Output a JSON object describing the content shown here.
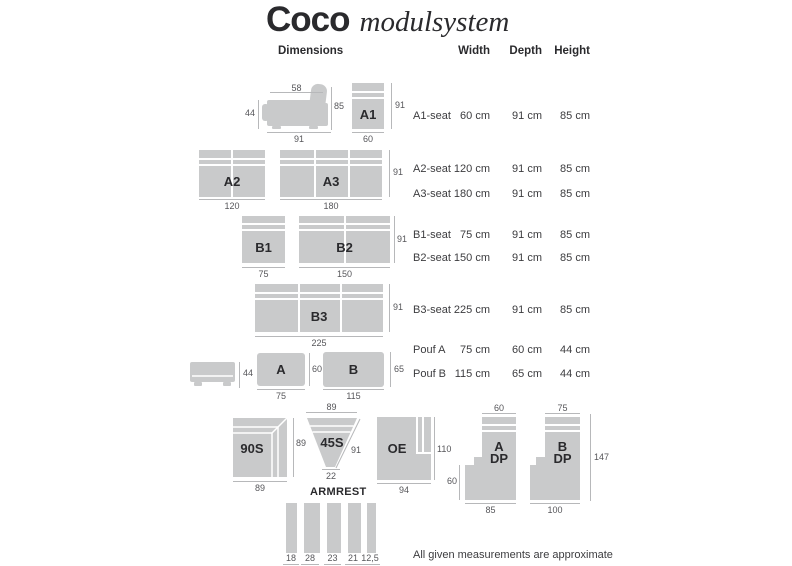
{
  "title": {
    "brand": "Coco",
    "suffix": "modulsystem"
  },
  "colors": {
    "module_fill": "#c9cacb",
    "line": "#b7b8ba",
    "dim_text": "#56565a",
    "text": "#3c3c3f",
    "heading_text": "#2a2a2d"
  },
  "sections": {
    "dimensions_label": "Dimensions",
    "armrest_label": "ARMREST"
  },
  "table": {
    "headers": {
      "width": "Width",
      "depth": "Depth",
      "height": "Height"
    },
    "rows": [
      {
        "name": "A1-seat",
        "width": "60 cm",
        "depth": "91 cm",
        "height": "85 cm"
      },
      {
        "name": "A2-seat",
        "width": "120 cm",
        "depth": "91 cm",
        "height": "85 cm"
      },
      {
        "name": "A3-seat",
        "width": "180 cm",
        "depth": "91 cm",
        "height": "85 cm"
      },
      {
        "name": "B1-seat",
        "width": "75 cm",
        "depth": "91 cm",
        "height": "85 cm"
      },
      {
        "name": "B2-seat",
        "width": "150 cm",
        "depth": "91 cm",
        "height": "85 cm"
      },
      {
        "name": "B3-seat",
        "width": "225 cm",
        "depth": "91 cm",
        "height": "85 cm"
      },
      {
        "name": "Pouf A",
        "width": "75 cm",
        "depth": "60 cm",
        "height": "44 cm"
      },
      {
        "name": "Pouf B",
        "width": "115 cm",
        "depth": "65 cm",
        "height": "44 cm"
      }
    ]
  },
  "modules": {
    "a1_side": {
      "top": "58",
      "left": "44",
      "right": "85",
      "bottom": "91"
    },
    "a1": {
      "label": "A1",
      "right": "91",
      "bottom": "60"
    },
    "a2": {
      "label": "A2",
      "bottom": "120"
    },
    "a3": {
      "label": "A3",
      "bottom": "180",
      "right": "91"
    },
    "b1": {
      "label": "B1",
      "bottom": "75"
    },
    "b2": {
      "label": "B2",
      "bottom": "150",
      "right": "91"
    },
    "b3": {
      "label": "B3",
      "bottom": "225",
      "right": "91"
    },
    "pouf_side": {
      "left": "44"
    },
    "pouf_a": {
      "label": "A",
      "right": "60",
      "bottom": "75"
    },
    "pouf_b": {
      "label": "B",
      "right": "65",
      "bottom": "115"
    },
    "corner_90": {
      "label": "90S",
      "right": "89",
      "bottom": "89"
    },
    "wedge_45": {
      "label": "45S",
      "top": "89",
      "diag": "91",
      "bottom": "22"
    },
    "oe": {
      "label": "OE",
      "right": "110",
      "bottom": "94"
    },
    "a_dp": {
      "label_line1": "A",
      "label_line2": "DP",
      "top": "60",
      "left": "60",
      "bottom": "85"
    },
    "b_dp": {
      "label_line1": "B",
      "label_line2": "DP",
      "top": "75",
      "bottom": "100",
      "right": "147"
    }
  },
  "armrest": {
    "widths": [
      "18",
      "28",
      "23",
      "21",
      "12,5"
    ]
  },
  "footnote": "All given measurements are approximate"
}
